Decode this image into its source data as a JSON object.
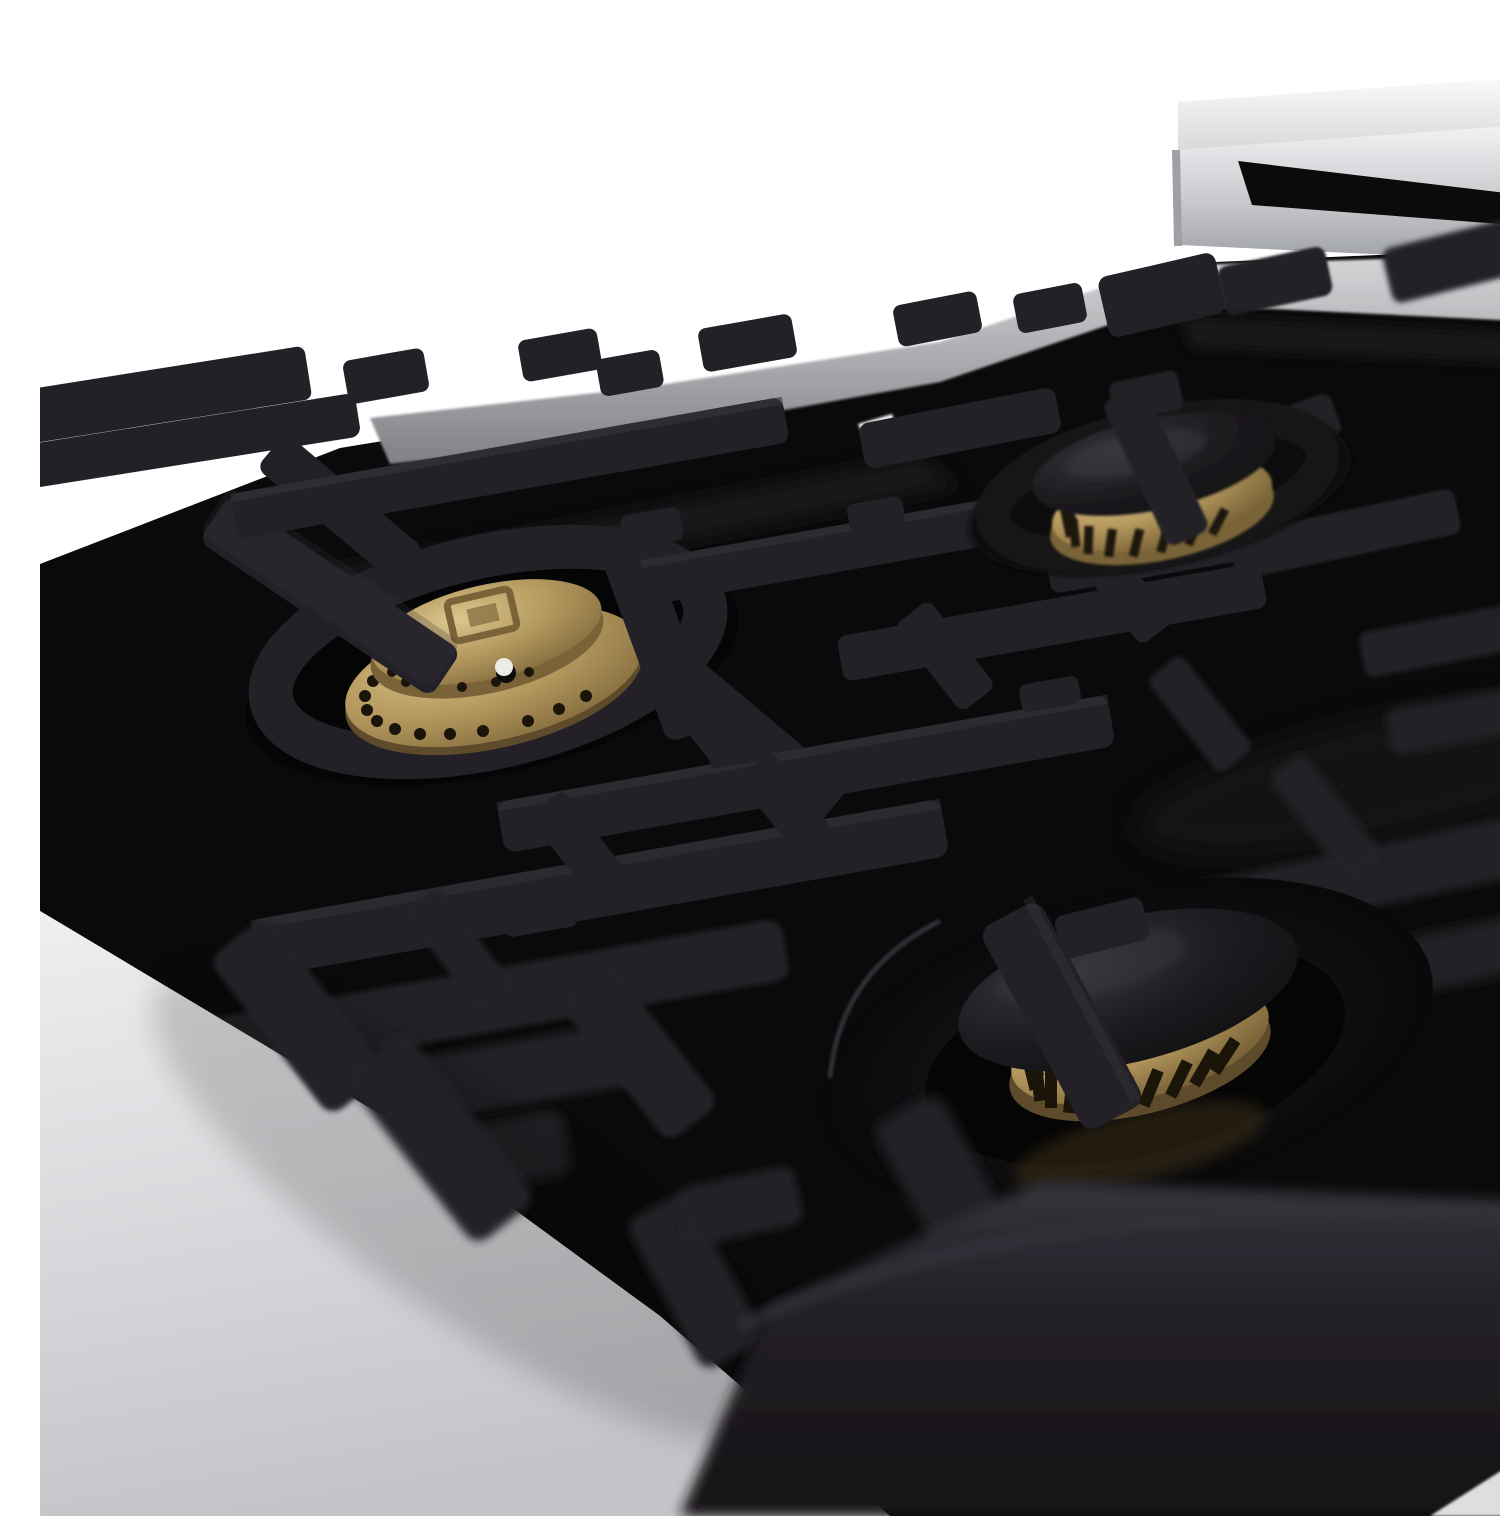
{
  "scene": {
    "type": "product-photo",
    "description": "Angled close-up of a gas range cooktop: glossy black porcelain surface, matte black cast-iron grates, brass burners, stainless steel backguard and side trim, photographed against a white studio background with shallow depth of field.",
    "background": "white"
  },
  "cooktop": {
    "surface_finish": "black porcelain",
    "grate_finish": "matte black cast iron",
    "side_panel": "stainless steel",
    "backguard": {
      "material": "stainless steel",
      "feature": "rear vent slot"
    },
    "burners": [
      {
        "position": "left",
        "finish": "brass",
        "detail": "two-tier brass burner head, embossed square emblem, white igniter electrode, ring of flame ports"
      },
      {
        "position": "back-right",
        "finish": "brass",
        "detail": "slotted brass burner ring with matte black cap"
      },
      {
        "position": "front-center",
        "finish": "brass",
        "detail": "slotted brass burner ring with matte black cap in glossy burner well"
      }
    ],
    "emblem": {
      "name": "square-emblem",
      "location": "left burner head"
    }
  },
  "colors": {
    "bg": "#ffffff",
    "steel_top_light": "#fafbfc",
    "steel_top_dark": "#d8d9db",
    "steel_front_light": "#f2f3f5",
    "steel_front_mid": "#c9cacd",
    "steel_front_dark": "#9da0a4",
    "steel_band_light": "#d5d6d8",
    "steel_band_dark": "#7f8185",
    "steel_side_light": "#efeff1",
    "steel_side_dark": "#c3c4c8",
    "steel_sliver": "#dddee0",
    "steel_glint": "#f4f4f5",
    "vent_slot": "#0b0b0c",
    "porcelain": "#0a0a0b",
    "sheen": "#1b1a1e",
    "iron": "#232127",
    "iron_hi": "#37353c",
    "iron_dark": "#141316",
    "brass_light": "#dcc68c",
    "brass_mid": "#b3975c",
    "brass_dark": "#7a6338",
    "brass_deep": "#5e4b2b",
    "port_hole": "#1b1509",
    "cap_light": "#38373d",
    "cap_mid": "#1c1b1f",
    "cap_dark": "#0e0e10",
    "igniter": "#edebe5",
    "igniter_shadow": "#0e0d0c",
    "gold_reflection": "#3a2f17",
    "well_center": "#1c1b1f",
    "well_mid": "#0e0d0f",
    "well_edge": "#050506",
    "mega_light": "#34333a",
    "mega_dark": "#121114",
    "shadow": "#000000"
  }
}
